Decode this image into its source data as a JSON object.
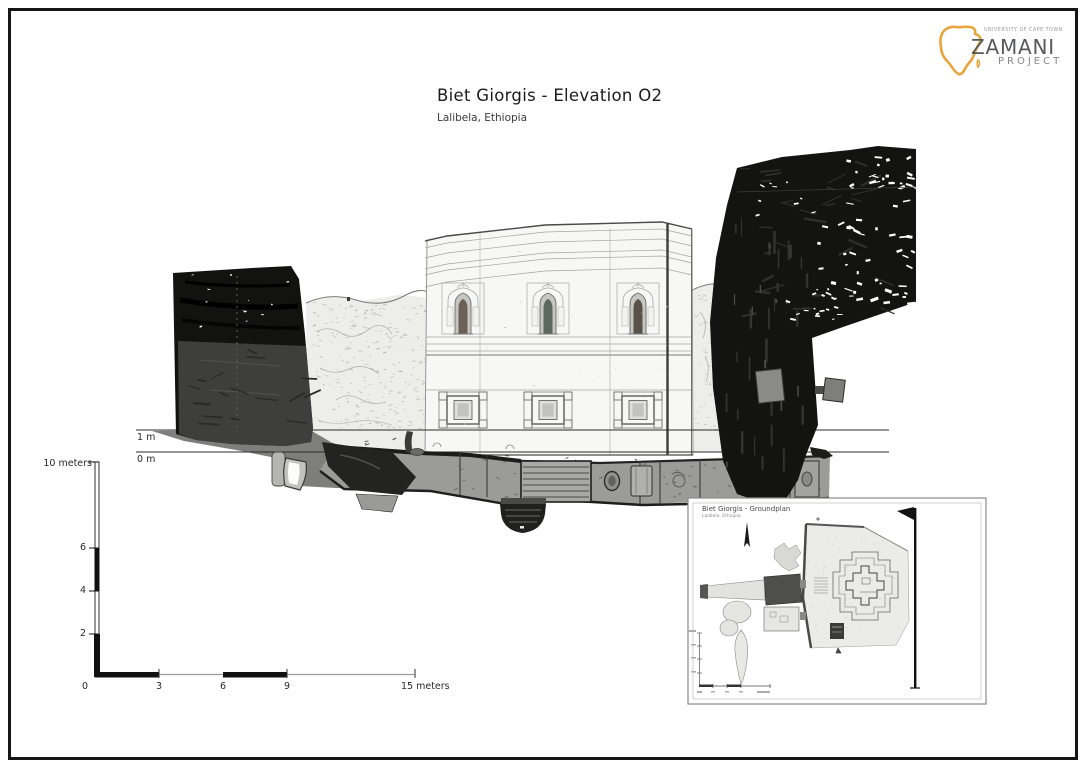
{
  "header": {
    "title": "Biet Giorgis - Elevation O2",
    "subtitle": "Lalibela, Ethiopia"
  },
  "logo": {
    "university": "UNIVERSITY OF CAPE TOWN",
    "name": "ZAMANI",
    "subname": "PROJECT",
    "africa_color": "#E9A43C"
  },
  "elevation": {
    "ref_labels": [
      "1 m",
      "0 m"
    ]
  },
  "scales": {
    "vertical": {
      "top_label": "10 meters",
      "ticks": [
        "6",
        "4",
        "2"
      ]
    },
    "origin": "0",
    "horizontal": {
      "ticks": [
        "3",
        "6",
        "9"
      ],
      "end_label": "15 meters"
    }
  },
  "inset": {
    "title": "Biet Giorgis - Groundplan",
    "subtitle": "Lalibela, Ethiopia"
  },
  "palette": {
    "rock_dark": "#131311",
    "rock_light": "#EDEDEA",
    "trench_gray": "#9B9B99",
    "ink": "#1b1b1b"
  }
}
